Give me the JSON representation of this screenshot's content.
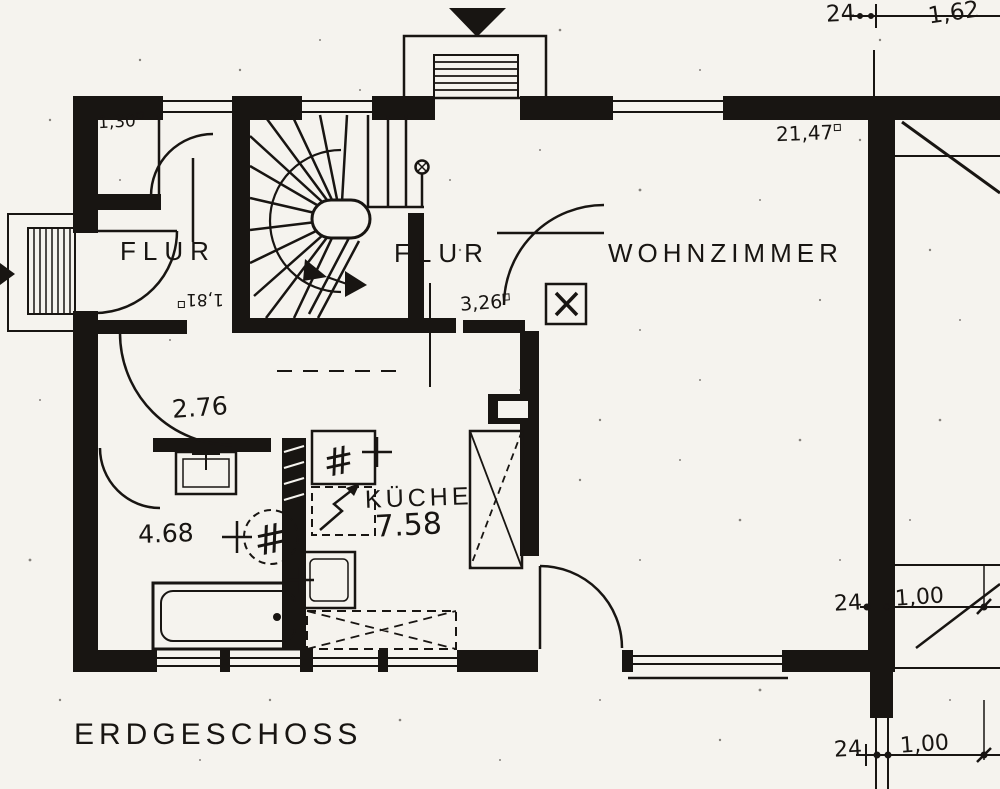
{
  "floor": {
    "label": "ERDGESCHOSS"
  },
  "rooms": {
    "flur_left": {
      "label": "FLUR"
    },
    "flur_mid": {
      "label": "FLUR",
      "area": "3,26"
    },
    "wohnzimmer": {
      "label": "WOHNZIMMER",
      "area": "21,47"
    },
    "kueche": {
      "label": "KÜCHE",
      "area": "7.58"
    },
    "bad": {
      "area": "4.68"
    },
    "wc": {
      "area": "2.76"
    },
    "abstellraum": {
      "area": "1,30"
    },
    "diele": {
      "area": "1,81"
    }
  },
  "dimensions": [
    {
      "id": "top",
      "wall_thickness": "24",
      "span": "1,62"
    },
    {
      "id": "right_middle",
      "wall_thickness": "24",
      "span": "1,00"
    },
    {
      "id": "right_bottom",
      "wall_thickness": "24",
      "span": "1,00"
    }
  ],
  "colors": {
    "ink": "#181512",
    "paper": "#f5f3ee"
  }
}
